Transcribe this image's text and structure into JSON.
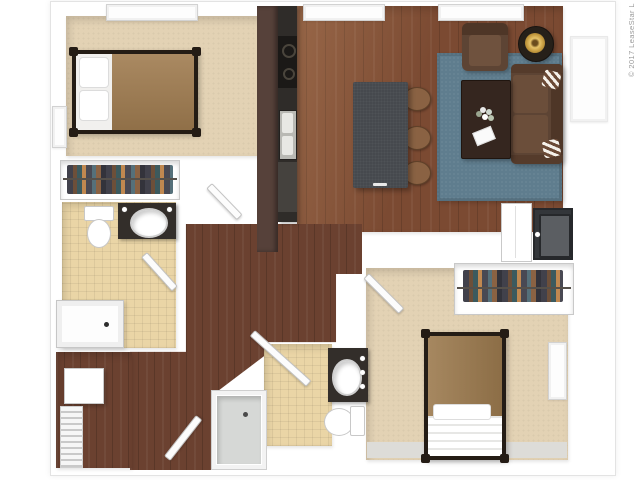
{
  "watermark": {
    "text": "© 2017 LeaseStar L"
  },
  "colors": {
    "wood_living": "#7b4a32",
    "wood_hall": "#6b4130",
    "carpet": "#e3d2b4",
    "tile": "#ead5a6",
    "cabinet_maroon": "#56413a",
    "counter_dark": "#2f2c29",
    "island_gray": "#46494e",
    "chair_brown": "#8a6243",
    "rug_blue": "#5f7d8e",
    "sofa_brown": "#5d4434",
    "coffee_table": "#35261f",
    "bowl_gold": "#c49a3f",
    "bed_frame": "#241c15",
    "blanket_tan": "#a07c50",
    "appliance_dark": "#33363a",
    "wall_white": "#ffffff"
  },
  "plan": {
    "type": "3d-floor-plan",
    "rooms": [
      {
        "name": "bedroom-1",
        "furniture": [
          "bed",
          "closet",
          "window"
        ]
      },
      {
        "name": "bathroom-1",
        "furniture": [
          "toilet",
          "vanity-sink",
          "bathtub"
        ]
      },
      {
        "name": "laundry-closet",
        "furniture": [
          "washer",
          "wire-shelving"
        ]
      },
      {
        "name": "kitchen",
        "furniture": [
          "cabinets",
          "stove",
          "sink",
          "dishwasher",
          "island"
        ]
      },
      {
        "name": "living-dining",
        "furniture": [
          "dining-table",
          "chairs",
          "rug",
          "sofa",
          "armchair",
          "side-table",
          "coffee-table"
        ]
      },
      {
        "name": "utility-closet",
        "furniture": [
          "washer-dryer",
          "cabinet"
        ]
      },
      {
        "name": "bedroom-2",
        "furniture": [
          "bed",
          "closet",
          "window"
        ]
      },
      {
        "name": "bathroom-2",
        "furniture": [
          "vanity-sink",
          "toilet",
          "shower"
        ]
      },
      {
        "name": "entry-hallway",
        "furniture": [
          "entry-door"
        ]
      }
    ]
  }
}
